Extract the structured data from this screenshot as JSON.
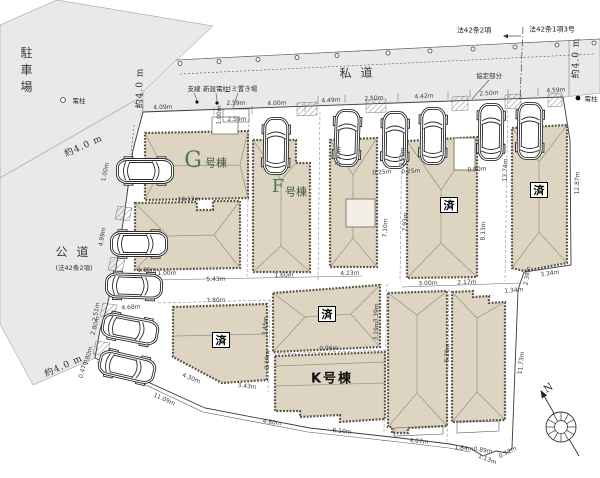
{
  "colors": {
    "building_fill": "#ddd4c1",
    "road_fill": "#e9e9e9",
    "green": "#4e7a50"
  },
  "labels": [
    {
      "n": "parking-lot-label",
      "t": "駐車場",
      "x": 26,
      "y": 72,
      "r": 0,
      "c": "vtext"
    },
    {
      "n": "public-road-label",
      "t": "公道",
      "x": 72,
      "y": 252,
      "r": 0,
      "c": "road"
    },
    {
      "n": "public-road-note",
      "t": "(法42条2項)",
      "x": 74,
      "y": 268,
      "r": 0,
      "c": "note"
    },
    {
      "n": "private-road-label",
      "t": "私道",
      "x": 356,
      "y": 73,
      "r": -2,
      "c": "road"
    },
    {
      "n": "law-42-2-label",
      "t": "法42条2項",
      "x": 474,
      "y": 31,
      "r": 0,
      "c": "law"
    },
    {
      "n": "law-42-1-3-label",
      "t": "法42条1項3号",
      "x": 552,
      "y": 30,
      "r": 0,
      "c": "law"
    },
    {
      "n": "agreement-part-label",
      "t": "協定部分",
      "x": 489,
      "y": 76,
      "r": 0,
      "c": "note"
    },
    {
      "n": "road-width-label",
      "t": "約4.0 m",
      "x": 84,
      "y": 147,
      "r": -24,
      "c": "roadw"
    },
    {
      "n": "road-width-label",
      "t": "約4.0 m",
      "x": 141,
      "y": 88,
      "r": -90,
      "c": "roadw"
    },
    {
      "n": "road-width-label",
      "t": "約4.0 m",
      "x": 577,
      "y": 58,
      "r": -90,
      "c": "roadw"
    },
    {
      "n": "road-width-label",
      "t": "約4.0 m",
      "x": 64,
      "y": 367,
      "r": -24,
      "c": "roadw"
    },
    {
      "n": "pole-note",
      "t": "電柱",
      "x": 79,
      "y": 101,
      "r": 0,
      "c": "note"
    },
    {
      "n": "pole-note",
      "t": "電柱",
      "x": 591,
      "y": 99,
      "r": 0,
      "c": "note"
    },
    {
      "n": "guy-wire-note",
      "t": "支線",
      "x": 194,
      "y": 89,
      "r": 0,
      "c": "note"
    },
    {
      "n": "new-pole-note",
      "t": "新設電柱",
      "x": 216,
      "y": 89,
      "r": 0,
      "c": "note"
    },
    {
      "n": "garbage-place-note",
      "t": "ゴミ置き場",
      "x": 241,
      "y": 89,
      "r": 0,
      "c": "note"
    },
    {
      "n": "building-g-label",
      "t": "G",
      "x": 193,
      "y": 161,
      "r": 0,
      "c": "gbig"
    },
    {
      "n": "building-g-suffix",
      "t": "号棟",
      "x": 216,
      "y": 163,
      "r": 0,
      "c": "gsuf"
    },
    {
      "n": "building-f-label",
      "t": "F",
      "x": 278,
      "y": 187,
      "r": 0,
      "c": "fbig"
    },
    {
      "n": "building-f-suffix",
      "t": "号棟",
      "x": 296,
      "y": 192,
      "r": 0,
      "c": "gsuf"
    },
    {
      "n": "building-k-label",
      "t": "K号棟",
      "x": 332,
      "y": 379,
      "r": 0,
      "c": "k"
    },
    {
      "n": "sold-badge",
      "t": "済",
      "x": 449,
      "y": 205,
      "r": 0,
      "c": "sold"
    },
    {
      "n": "sold-badge",
      "t": "済",
      "x": 539,
      "y": 190,
      "r": 0,
      "c": "sold"
    },
    {
      "n": "sold-badge",
      "t": "済",
      "x": 221,
      "y": 340,
      "r": 0,
      "c": "sold"
    },
    {
      "n": "sold-badge",
      "t": "済",
      "x": 327,
      "y": 314,
      "r": 0,
      "c": "sold"
    },
    {
      "n": "compass-n-label",
      "t": "N",
      "x": 549,
      "y": 389,
      "r": -32,
      "c": "n"
    },
    {
      "n": "dimension-label",
      "t": "4.09m",
      "x": 163,
      "y": 108,
      "r": -2,
      "c": "dim"
    },
    {
      "n": "dimension-label",
      "t": "2.59m",
      "x": 236,
      "y": 104,
      "r": 0,
      "c": "dim"
    },
    {
      "n": "dimension-label",
      "t": "1.00m",
      "x": 220,
      "y": 115,
      "r": -90,
      "c": "dim"
    },
    {
      "n": "dimension-label",
      "t": "2.59m",
      "x": 237,
      "y": 120,
      "r": 0,
      "c": "dim"
    },
    {
      "n": "dimension-label",
      "t": "4.00m",
      "x": 277,
      "y": 104,
      "r": -2,
      "c": "dim"
    },
    {
      "n": "dimension-label",
      "t": "4.49m",
      "x": 331,
      "y": 101,
      "r": -3,
      "c": "dim"
    },
    {
      "n": "dimension-label",
      "t": "2.50m",
      "x": 374,
      "y": 99,
      "r": -3,
      "c": "dim"
    },
    {
      "n": "dimension-label",
      "t": "4.42m",
      "x": 424,
      "y": 97,
      "r": -3,
      "c": "dim"
    },
    {
      "n": "dimension-label",
      "t": "2.50m",
      "x": 489,
      "y": 94,
      "r": -3,
      "c": "dim"
    },
    {
      "n": "dimension-label",
      "t": "4.59m",
      "x": 556,
      "y": 91,
      "r": -3,
      "c": "dim"
    },
    {
      "n": "dimension-label",
      "t": "1.00m",
      "x": 106,
      "y": 172,
      "r": -78,
      "c": "dim"
    },
    {
      "n": "dimension-label",
      "t": "4.99m",
      "x": 103,
      "y": 237,
      "r": -80,
      "c": "dim"
    },
    {
      "n": "dimension-label",
      "t": "2.51m",
      "x": 97,
      "y": 312,
      "r": -80,
      "c": "dim"
    },
    {
      "n": "dimension-label",
      "t": "1.85m",
      "x": 147,
      "y": 271,
      "r": 0,
      "c": "dim"
    },
    {
      "n": "dimension-label",
      "t": "1.00m",
      "x": 167,
      "y": 274,
      "r": 0,
      "c": "dim"
    },
    {
      "n": "dimension-label",
      "t": "10.13m",
      "x": 189,
      "y": 200,
      "r": -1,
      "c": "dim"
    },
    {
      "n": "dimension-label",
      "t": "5.43m",
      "x": 216,
      "y": 280,
      "r": -1,
      "c": "dim"
    },
    {
      "n": "dimension-label",
      "t": "1.60m",
      "x": 284,
      "y": 276,
      "r": -1,
      "c": "dim"
    },
    {
      "n": "dimension-label",
      "t": "4.23m",
      "x": 350,
      "y": 274,
      "r": -2,
      "c": "dim"
    },
    {
      "n": "dimension-label",
      "t": "0.25m",
      "x": 382,
      "y": 173,
      "r": -3,
      "c": "dim"
    },
    {
      "n": "dimension-label",
      "t": "0.25m",
      "x": 411,
      "y": 172,
      "r": -3,
      "c": "dim"
    },
    {
      "n": "dimension-label",
      "t": "0.90m",
      "x": 477,
      "y": 170,
      "r": -3,
      "c": "dim"
    },
    {
      "n": "dimension-label",
      "t": "3.50m",
      "x": 339,
      "y": 156,
      "r": -86,
      "c": "dim"
    },
    {
      "n": "dimension-label",
      "t": "3.50m",
      "x": 403,
      "y": 157,
      "r": -86,
      "c": "dim"
    },
    {
      "n": "dimension-label",
      "t": "7.10m",
      "x": 386,
      "y": 228,
      "r": -87,
      "c": "dim"
    },
    {
      "n": "dimension-label",
      "t": "7.93m",
      "x": 406,
      "y": 222,
      "r": -88,
      "c": "dim"
    },
    {
      "n": "dimension-label",
      "t": "8.13m",
      "x": 484,
      "y": 231,
      "r": -88,
      "c": "dim"
    },
    {
      "n": "dimension-label",
      "t": "13.74m",
      "x": 506,
      "y": 170,
      "r": -88,
      "c": "dim"
    },
    {
      "n": "dimension-label",
      "t": "12.87m",
      "x": 578,
      "y": 183,
      "r": -88,
      "c": "dim"
    },
    {
      "n": "dimension-label",
      "t": "3.00m",
      "x": 428,
      "y": 284,
      "r": -2,
      "c": "dim"
    },
    {
      "n": "dimension-label",
      "t": "2.17m",
      "x": 467,
      "y": 283,
      "r": -2,
      "c": "dim"
    },
    {
      "n": "dimension-label",
      "t": "1.34m",
      "x": 514,
      "y": 291,
      "r": -5,
      "c": "dim"
    },
    {
      "n": "dimension-label",
      "t": "2.38m",
      "x": 528,
      "y": 276,
      "r": -80,
      "c": "dim"
    },
    {
      "n": "dimension-label",
      "t": "3.34m",
      "x": 550,
      "y": 274,
      "r": -8,
      "c": "dim"
    },
    {
      "n": "dimension-label",
      "t": "7.80m",
      "x": 216,
      "y": 301,
      "r": -2,
      "c": "dim"
    },
    {
      "n": "dimension-label",
      "t": "4.68m",
      "x": 131,
      "y": 308,
      "r": -3,
      "c": "dim"
    },
    {
      "n": "dimension-label",
      "t": "2.80m",
      "x": 96,
      "y": 326,
      "r": -74,
      "c": "dim"
    },
    {
      "n": "dimension-label",
      "t": "1.80m",
      "x": 89,
      "y": 356,
      "r": -74,
      "c": "dim"
    },
    {
      "n": "dimension-label",
      "t": "0.47m",
      "x": 84,
      "y": 369,
      "r": -74,
      "c": "dim"
    },
    {
      "n": "dimension-label",
      "t": "4.30m",
      "x": 191,
      "y": 379,
      "r": 22,
      "c": "dim"
    },
    {
      "n": "dimension-label",
      "t": "3.43m",
      "x": 247,
      "y": 387,
      "r": 6,
      "c": "dim"
    },
    {
      "n": "dimension-label",
      "t": "3.45m",
      "x": 266,
      "y": 326,
      "r": -86,
      "c": "dim"
    },
    {
      "n": "dimension-label",
      "t": "2.19m",
      "x": 268,
      "y": 360,
      "r": -86,
      "c": "dim"
    },
    {
      "n": "dimension-label",
      "t": "0.96m",
      "x": 329,
      "y": 349,
      "r": -2,
      "c": "dim"
    },
    {
      "n": "dimension-label",
      "t": "3.39m",
      "x": 377,
      "y": 313,
      "r": -86,
      "c": "dim"
    },
    {
      "n": "dimension-label",
      "t": "3.19m",
      "x": 377,
      "y": 331,
      "r": -86,
      "c": "dim"
    },
    {
      "n": "dimension-label",
      "t": "11.09m",
      "x": 164,
      "y": 400,
      "r": 24,
      "c": "dim"
    },
    {
      "n": "dimension-label",
      "t": "4.80m",
      "x": 272,
      "y": 423,
      "r": 8,
      "c": "dim"
    },
    {
      "n": "dimension-label",
      "t": "6.10m",
      "x": 342,
      "y": 432,
      "r": 6,
      "c": "dim"
    },
    {
      "n": "dimension-label",
      "t": "4.07m",
      "x": 419,
      "y": 442,
      "r": 5,
      "c": "dim"
    },
    {
      "n": "dimension-label",
      "t": "1.84m",
      "x": 464,
      "y": 449,
      "r": 6,
      "c": "dim"
    },
    {
      "n": "dimension-label",
      "t": "0.89m",
      "x": 483,
      "y": 451,
      "r": 8,
      "c": "dim"
    },
    {
      "n": "dimension-label",
      "t": "1.13m",
      "x": 487,
      "y": 460,
      "r": 22,
      "c": "dim"
    },
    {
      "n": "dimension-label",
      "t": "0.72m",
      "x": 508,
      "y": 453,
      "r": -28,
      "c": "dim"
    },
    {
      "n": "dimension-label",
      "t": "11.73m",
      "x": 522,
      "y": 363,
      "r": -84,
      "c": "dim"
    },
    {
      "n": "dimension-label",
      "t": "5.20m",
      "x": 448,
      "y": 353,
      "r": -87,
      "c": "dim"
    }
  ]
}
